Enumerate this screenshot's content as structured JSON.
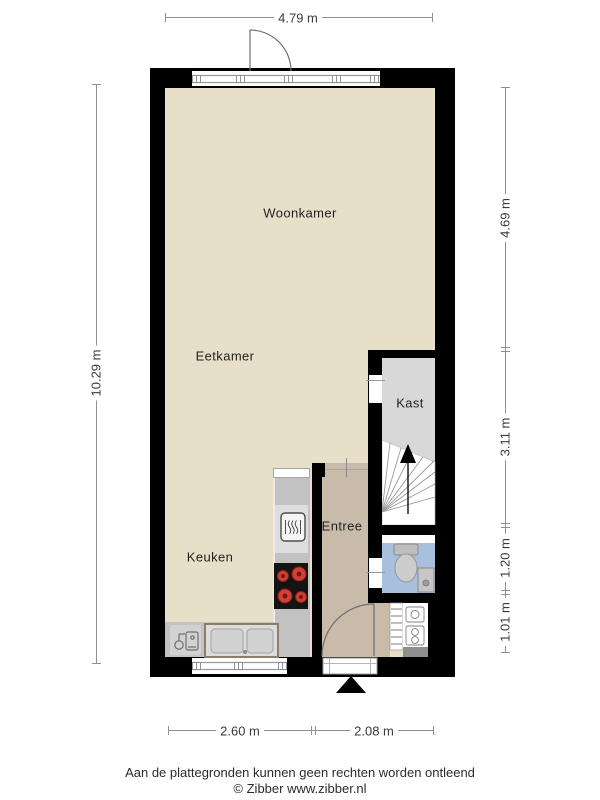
{
  "dimensions": {
    "top": "4.79 m",
    "left": "10.29 m",
    "right_segments": [
      "4.69 m",
      "3.11 m",
      "1.20 m",
      "1.01 m"
    ],
    "bottom_segments": [
      "2.60 m",
      "2.08 m"
    ]
  },
  "rooms": {
    "woonkamer": "Woonkamer",
    "eetkamer": "Eetkamer",
    "keuken": "Keuken",
    "entree": "Entree",
    "kast": "Kast"
  },
  "fixtures": [
    "top-window",
    "balcony-door",
    "kast-doorway",
    "winder-stairs-up",
    "toilet",
    "hand-basin",
    "oven",
    "induction-hob",
    "double-sink",
    "boiler-tap",
    "meter-cabinet",
    "louver-door",
    "kitchen-window",
    "entrance-door",
    "entrance-marker"
  ],
  "footer": {
    "disclaimer": "Aan de plattegronden kunnen geen rechten worden ontleend",
    "credit": "© Zibber www.zibber.nl"
  },
  "colors": {
    "wall": "#000000",
    "living_floor": "#e7dfc8",
    "hall_floor": "#c9bbaa",
    "closet_floor": "#d8d8d8",
    "toilet_floor": "#a8c0dd",
    "counter": "#c2c2c2",
    "hob_burner": "#cf4036",
    "dimension_line": "#8f8f8f"
  }
}
